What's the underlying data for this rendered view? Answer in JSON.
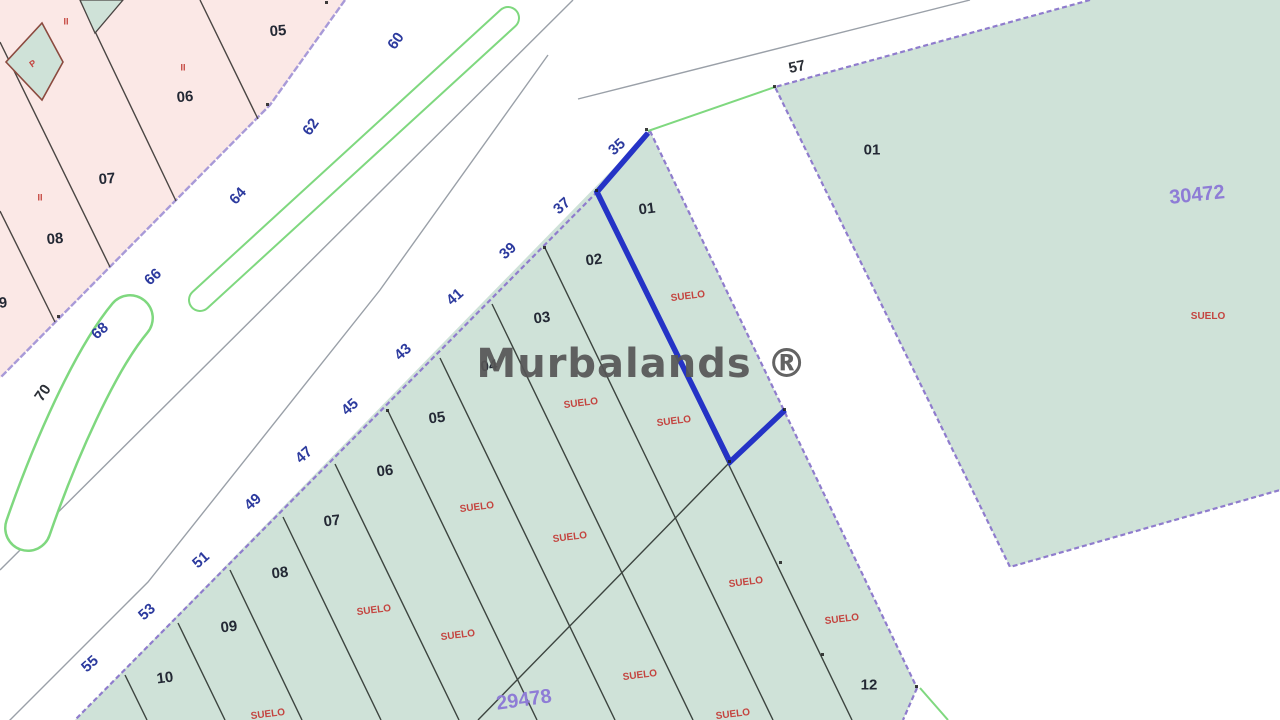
{
  "watermark": {
    "text": "Murbalands ®"
  },
  "colors": {
    "parcel_green_fill": "#cfe2d8",
    "pink_block_fill": "#fbe8e6",
    "block_boundary_purple": "#8f7ccd",
    "pink_boundary_purple": "#a89ad8",
    "parcel_line_dark": "#3c443f",
    "pink_line_dark": "#4a4543",
    "kerb_gray": "#9aa0a8",
    "road_green_line": "#7fd87f",
    "highlight_blue": "#2533c6",
    "street_number_blue": "#2c3a9e",
    "number_dark": "#262b36",
    "suelo_red": "#c4443f",
    "cadastral_ref_purple": "#8e7cd6",
    "watermark_gray": "#565656",
    "diamond_border_red": "#8b4a3f"
  },
  "labels": {
    "street_numbers_blue": {
      "prefix": "street-number",
      "color": "#2c3a9e",
      "size": 15,
      "weight": 700,
      "items": [
        {
          "t": "35",
          "x": 617,
          "y": 147,
          "r": -42
        },
        {
          "t": "37",
          "x": 562,
          "y": 206,
          "r": -42
        },
        {
          "t": "39",
          "x": 508,
          "y": 251,
          "r": -42
        },
        {
          "t": "41",
          "x": 455,
          "y": 297,
          "r": -42
        },
        {
          "t": "43",
          "x": 403,
          "y": 352,
          "r": -42
        },
        {
          "t": "45",
          "x": 350,
          "y": 407,
          "r": -42
        },
        {
          "t": "47",
          "x": 304,
          "y": 455,
          "r": -42
        },
        {
          "t": "49",
          "x": 253,
          "y": 502,
          "r": -42
        },
        {
          "t": "51",
          "x": 201,
          "y": 560,
          "r": -42
        },
        {
          "t": "53",
          "x": 147,
          "y": 612,
          "r": -42
        },
        {
          "t": "55",
          "x": 90,
          "y": 664,
          "r": -42
        },
        {
          "t": "60",
          "x": 396,
          "y": 41,
          "r": -55
        },
        {
          "t": "62",
          "x": 311,
          "y": 127,
          "r": -55
        },
        {
          "t": "64",
          "x": 238,
          "y": 196,
          "r": -48
        },
        {
          "t": "66",
          "x": 153,
          "y": 277,
          "r": -42
        },
        {
          "t": "68",
          "x": 100,
          "y": 331,
          "r": -42
        }
      ]
    },
    "street_numbers_dark": {
      "prefix": "street-number",
      "color": "#2b2f36",
      "size": 15,
      "weight": 700,
      "items": [
        {
          "t": "70",
          "x": 43,
          "y": 393,
          "r": -55
        },
        {
          "t": "57",
          "x": 797,
          "y": 67,
          "r": -12
        }
      ]
    },
    "parcel_numbers": {
      "prefix": "parcel-number",
      "color": "#232834",
      "size": 15,
      "weight": 700,
      "items": [
        {
          "t": "01",
          "x": 647,
          "y": 209,
          "r": -7
        },
        {
          "t": "02",
          "x": 594,
          "y": 260,
          "r": -7
        },
        {
          "t": "03",
          "x": 542,
          "y": 318,
          "r": -7
        },
        {
          "t": "04",
          "x": 489,
          "y": 366,
          "r": -7
        },
        {
          "t": "05",
          "x": 437,
          "y": 418,
          "r": -7
        },
        {
          "t": "06",
          "x": 385,
          "y": 471,
          "r": -7
        },
        {
          "t": "07",
          "x": 332,
          "y": 521,
          "r": -7
        },
        {
          "t": "08",
          "x": 280,
          "y": 573,
          "r": -7
        },
        {
          "t": "09",
          "x": 229,
          "y": 627,
          "r": -7
        },
        {
          "t": "10",
          "x": 165,
          "y": 678,
          "r": -7
        },
        {
          "t": "12",
          "x": 869,
          "y": 685,
          "r": 0
        },
        {
          "t": "01",
          "x": 872,
          "y": 150,
          "r": 0
        },
        {
          "t": "05",
          "x": 278,
          "y": 31,
          "r": -5
        },
        {
          "t": "06",
          "x": 185,
          "y": 97,
          "r": -5
        },
        {
          "t": "07",
          "x": 107,
          "y": 179,
          "r": -5
        },
        {
          "t": "08",
          "x": 55,
          "y": 239,
          "r": -5
        },
        {
          "t": "9",
          "x": 3,
          "y": 303,
          "r": -5
        }
      ]
    },
    "land_use_labels": {
      "prefix": "suelo-label",
      "color": "#c4443f",
      "size": 10,
      "weight": 700,
      "items": [
        {
          "t": "SUELO",
          "x": 688,
          "y": 297,
          "r": -7
        },
        {
          "t": "SUELO",
          "x": 581,
          "y": 404,
          "r": -7
        },
        {
          "t": "SUELO",
          "x": 674,
          "y": 422,
          "r": -7
        },
        {
          "t": "SUELO",
          "x": 477,
          "y": 508,
          "r": -7
        },
        {
          "t": "SUELO",
          "x": 570,
          "y": 538,
          "r": -7
        },
        {
          "t": "SUELO",
          "x": 746,
          "y": 583,
          "r": -7
        },
        {
          "t": "SUELO",
          "x": 374,
          "y": 611,
          "r": -7
        },
        {
          "t": "SUELO",
          "x": 458,
          "y": 636,
          "r": -7
        },
        {
          "t": "SUELO",
          "x": 842,
          "y": 620,
          "r": -7
        },
        {
          "t": "SUELO",
          "x": 640,
          "y": 676,
          "r": -7
        },
        {
          "t": "SUELO",
          "x": 268,
          "y": 715,
          "r": -7
        },
        {
          "t": "SUELO",
          "x": 733,
          "y": 715,
          "r": -7
        },
        {
          "t": "SUELO",
          "x": 1208,
          "y": 317,
          "r": 0
        }
      ]
    },
    "cadastral_refs": {
      "prefix": "cadastral-ref",
      "color": "#8e7cd6",
      "size": 20,
      "weight": 700,
      "items": [
        {
          "t": "30472",
          "x": 1197,
          "y": 195,
          "r": -6
        },
        {
          "t": "29478",
          "x": 524,
          "y": 700,
          "r": -8
        }
      ]
    },
    "symbols": {
      "prefix": "symbol",
      "color": "#c4443f",
      "size": 9,
      "weight": 700,
      "items": [
        {
          "t": "II",
          "x": 66,
          "y": 22,
          "r": 0
        },
        {
          "t": "II",
          "x": 183,
          "y": 68,
          "r": 0
        },
        {
          "t": "II",
          "x": 40,
          "y": 198,
          "r": 0
        },
        {
          "t": "P",
          "x": 33,
          "y": 64,
          "r": -35
        }
      ]
    }
  }
}
